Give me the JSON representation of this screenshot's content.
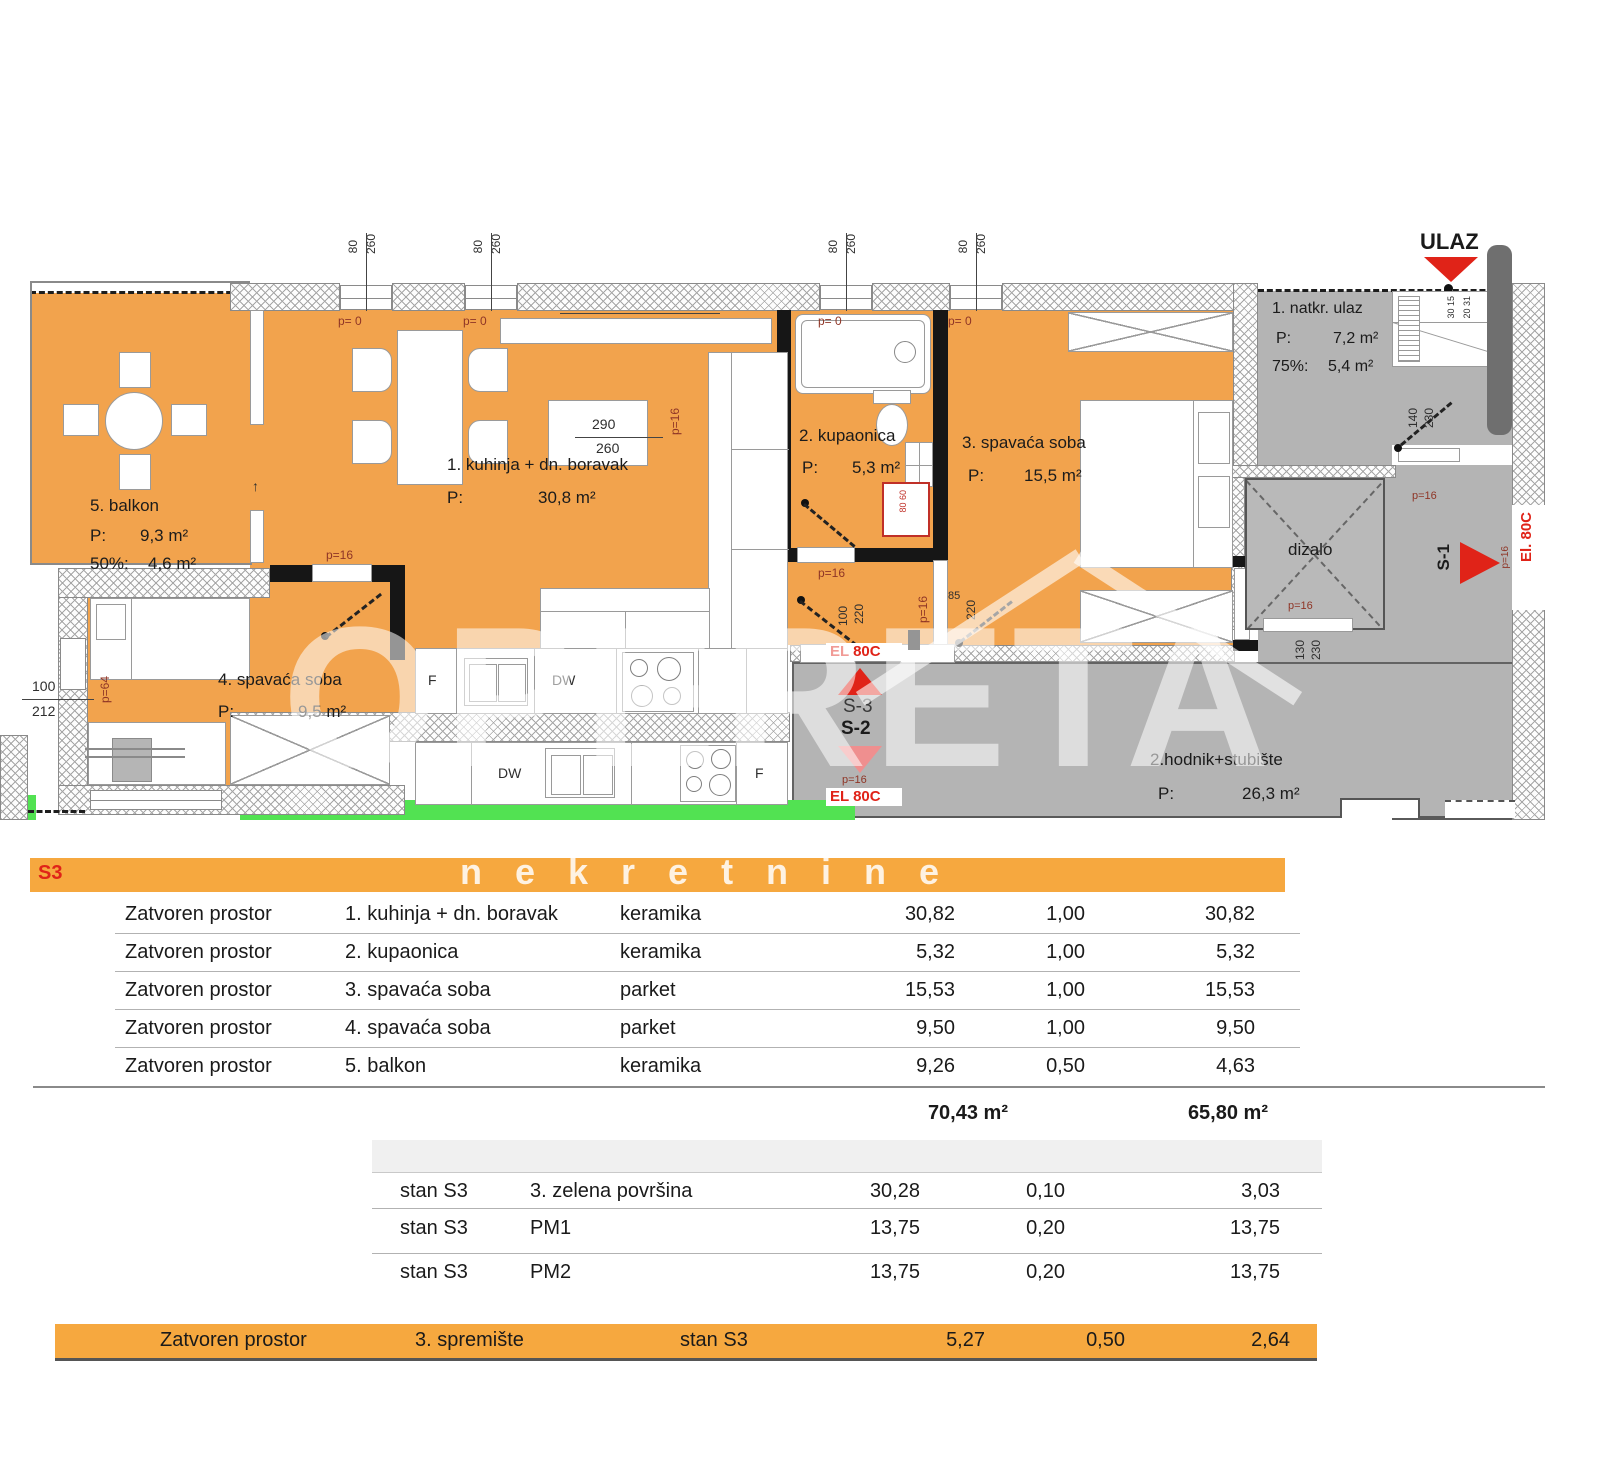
{
  "colors": {
    "room_orange": "#F2A34D",
    "bar_orange": "#F6A83F",
    "hall_gray": "#B4B4B4",
    "grass_green": "#52E252",
    "accent_red": "#E02318"
  },
  "plan": {
    "entrance": {
      "label": "ULAZ"
    },
    "rooms": {
      "kitchen_living": {
        "name": "1. kuhinja + dn. boravak",
        "p": "P:",
        "area": "30,8 m²"
      },
      "bathroom": {
        "name": "2. kupaonica",
        "p": "P:",
        "area": "5,3 m²"
      },
      "bedroom3": {
        "name": "3. spavaća soba",
        "p": "P:",
        "area": "15,5 m²"
      },
      "bedroom4": {
        "name": "4. spavaća soba",
        "p": "P:",
        "area": "9,5 m²"
      },
      "balcony": {
        "name": "5. balkon",
        "p": "P:",
        "area": "9,3 m²",
        "pct": "50%:",
        "pct_area": "4,6 m²"
      },
      "covered_entrance": {
        "name": "1. natkr. ulaz",
        "p": "P:",
        "area": "7,2 m²",
        "pct": "75%:",
        "pct_area": "5,4 m²"
      },
      "hallway_stairs": {
        "name": "2.hodnik+stubište",
        "p": "P:",
        "area": "26,3 m²"
      },
      "elevator": {
        "name": "dizalo"
      }
    },
    "markers": {
      "s1": "S-1",
      "s2": "S-2",
      "s3": "S-3",
      "el_boc": "El. 80C",
      "el_boc_caps": "EL 80C",
      "arrow_up": "↑"
    },
    "appliances": {
      "fridge": "F",
      "dishwasher": "DW"
    },
    "dims": {
      "win_w": "80",
      "win_h": "260",
      "p0": "p= 0",
      "p16": "p=16",
      "p64": "p=64",
      "d290": "290",
      "d260": "260",
      "d100": "100",
      "d212": "212",
      "d140": "140",
      "d230": "230",
      "d130": "130",
      "d220": "220",
      "d85": "85",
      "step_a": "30 15",
      "step_b": "20 31"
    }
  },
  "watermark": {
    "brand": "OPERETA",
    "sub": "nekretnine"
  },
  "table": {
    "header": "S3",
    "rows": [
      {
        "zone": "Zatvoren prostor",
        "name": "1. kuhinja + dn. boravak",
        "material": "keramika",
        "area": "30,82",
        "coef": "1,00",
        "result": "30,82"
      },
      {
        "zone": "Zatvoren prostor",
        "name": "2. kupaonica",
        "material": "keramika",
        "area": "5,32",
        "coef": "1,00",
        "result": "5,32"
      },
      {
        "zone": "Zatvoren prostor",
        "name": "3. spavaća soba",
        "material": "parket",
        "area": "15,53",
        "coef": "1,00",
        "result": "15,53"
      },
      {
        "zone": "Zatvoren prostor",
        "name": "4. spavaća soba",
        "material": "parket",
        "area": "9,50",
        "coef": "1,00",
        "result": "9,50"
      },
      {
        "zone": "Zatvoren prostor",
        "name": "5. balkon",
        "material": "keramika",
        "area": "9,26",
        "coef": "0,50",
        "result": "4,63"
      }
    ],
    "totals": {
      "gross": "70,43 m²",
      "net": "65,80 m²"
    },
    "extra_rows": [
      {
        "unit": "stan S3",
        "name": "3. zelena površina",
        "area": "30,28",
        "coef": "0,10",
        "result": "3,03"
      },
      {
        "unit": "stan S3",
        "name": "PM1",
        "area": "13,75",
        "coef": "0,20",
        "result": "13,75"
      },
      {
        "unit": "stan S3",
        "name": "PM2",
        "area": "13,75",
        "coef": "0,20",
        "result": "13,75"
      }
    ],
    "storage_row": {
      "zone": "Zatvoren prostor",
      "name": "3. spremište",
      "unit": "stan S3",
      "area": "5,27",
      "coef": "0,50",
      "result": "2,64"
    }
  }
}
